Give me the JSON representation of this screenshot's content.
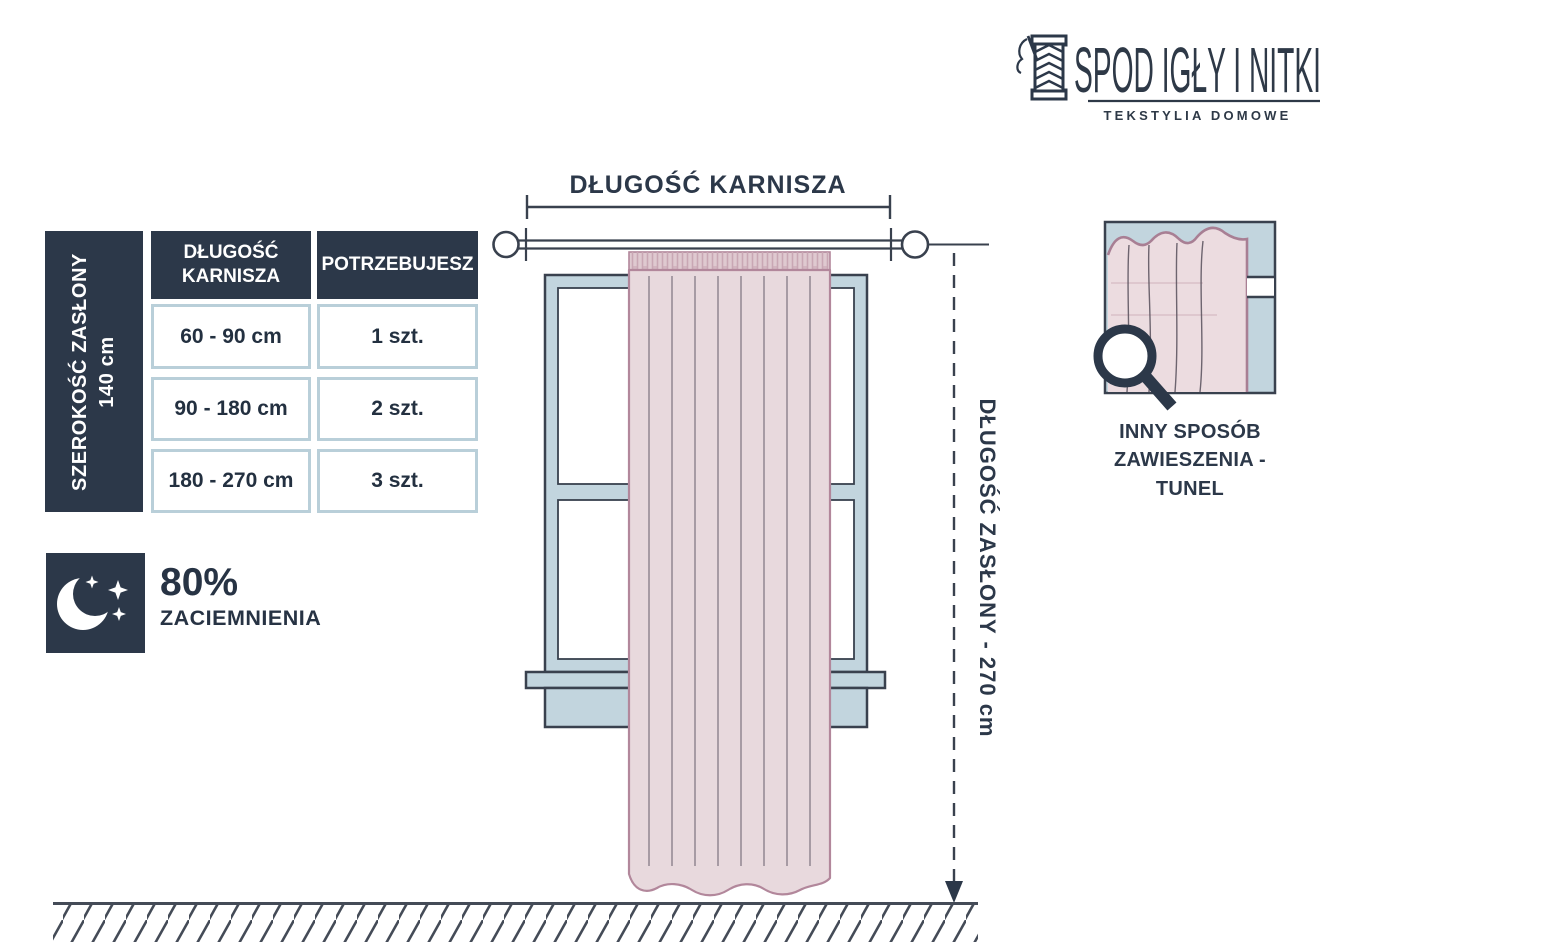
{
  "brand": {
    "name": "SPOD IGŁY I NITKI",
    "tagline": "TEKSTYLIA DOMOWE"
  },
  "size_table": {
    "side_label_line1": "SZEROKOŚĆ ZASŁONY",
    "side_label_line2": "140 cm",
    "col1_header": "DŁUGOŚĆ KARNISZA",
    "col2_header": "POTRZEBUJESZ",
    "rows": [
      {
        "rod_length": "60 - 90 cm",
        "quantity": "1 szt."
      },
      {
        "rod_length": "90 - 180 cm",
        "quantity": "2 szt."
      },
      {
        "rod_length": "180 - 270 cm",
        "quantity": "3 szt."
      }
    ]
  },
  "blackout": {
    "percent": "80%",
    "label": "ZACIEMNIENIA"
  },
  "diagram": {
    "rod_length_label": "DŁUGOŚĆ KARNISZA",
    "curtain_length_label": "DŁUGOŚĆ ZASŁONY - 270 cm"
  },
  "hanging_detail": {
    "caption_line1": "INNY SPOSÓB",
    "caption_line2": "ZAWIESZENIA - TUNEL"
  },
  "colors": {
    "navy": "#2c3849",
    "outline": "#39414e",
    "window_blue": "#c2d5de",
    "curtain_pink": "#e8d9dd",
    "curtain_border": "#b2879b",
    "cell_border": "#b9cfd9"
  }
}
